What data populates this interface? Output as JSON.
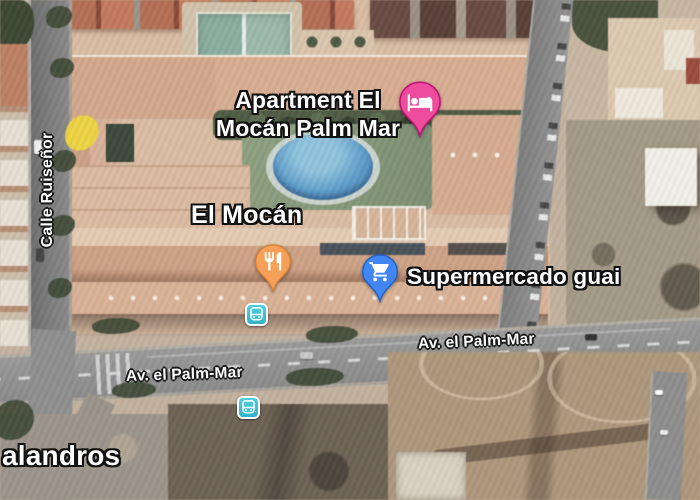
{
  "labels": {
    "apartment": {
      "line1": "Apartment El",
      "line2": "Mocán Palm Mar"
    },
    "poi_el_mocan": "El Mocán",
    "poi_supermercado": "Supermercado guai",
    "street_av_el_palm_mar": "Av. el Palm-Mar",
    "street_calle_ruisenor": "Calle Ruiseñor",
    "place_partial": "alandros"
  },
  "markers": {
    "lodging_pin": {
      "icon": "bed-icon",
      "color": "#ee4d9e"
    },
    "restaurant_pin": {
      "icon": "fork-knife-icon",
      "color": "#f7a05a"
    },
    "supermarket_pin": {
      "icon": "shopping-cart-icon",
      "color": "#4285f4"
    },
    "bus_stop": {
      "icon": "bus-icon",
      "color": "#3fc1d3",
      "count": 2
    }
  },
  "colors": {
    "pool": "#5b9fd0",
    "lawn": "#8ea27f",
    "roof": "#d6a98c",
    "road": "#979797",
    "tennis_court": "#86b1a0",
    "tree": "#3f4a35",
    "dirt": "#b0977a",
    "landmark_yellow": "#f0d23e"
  }
}
